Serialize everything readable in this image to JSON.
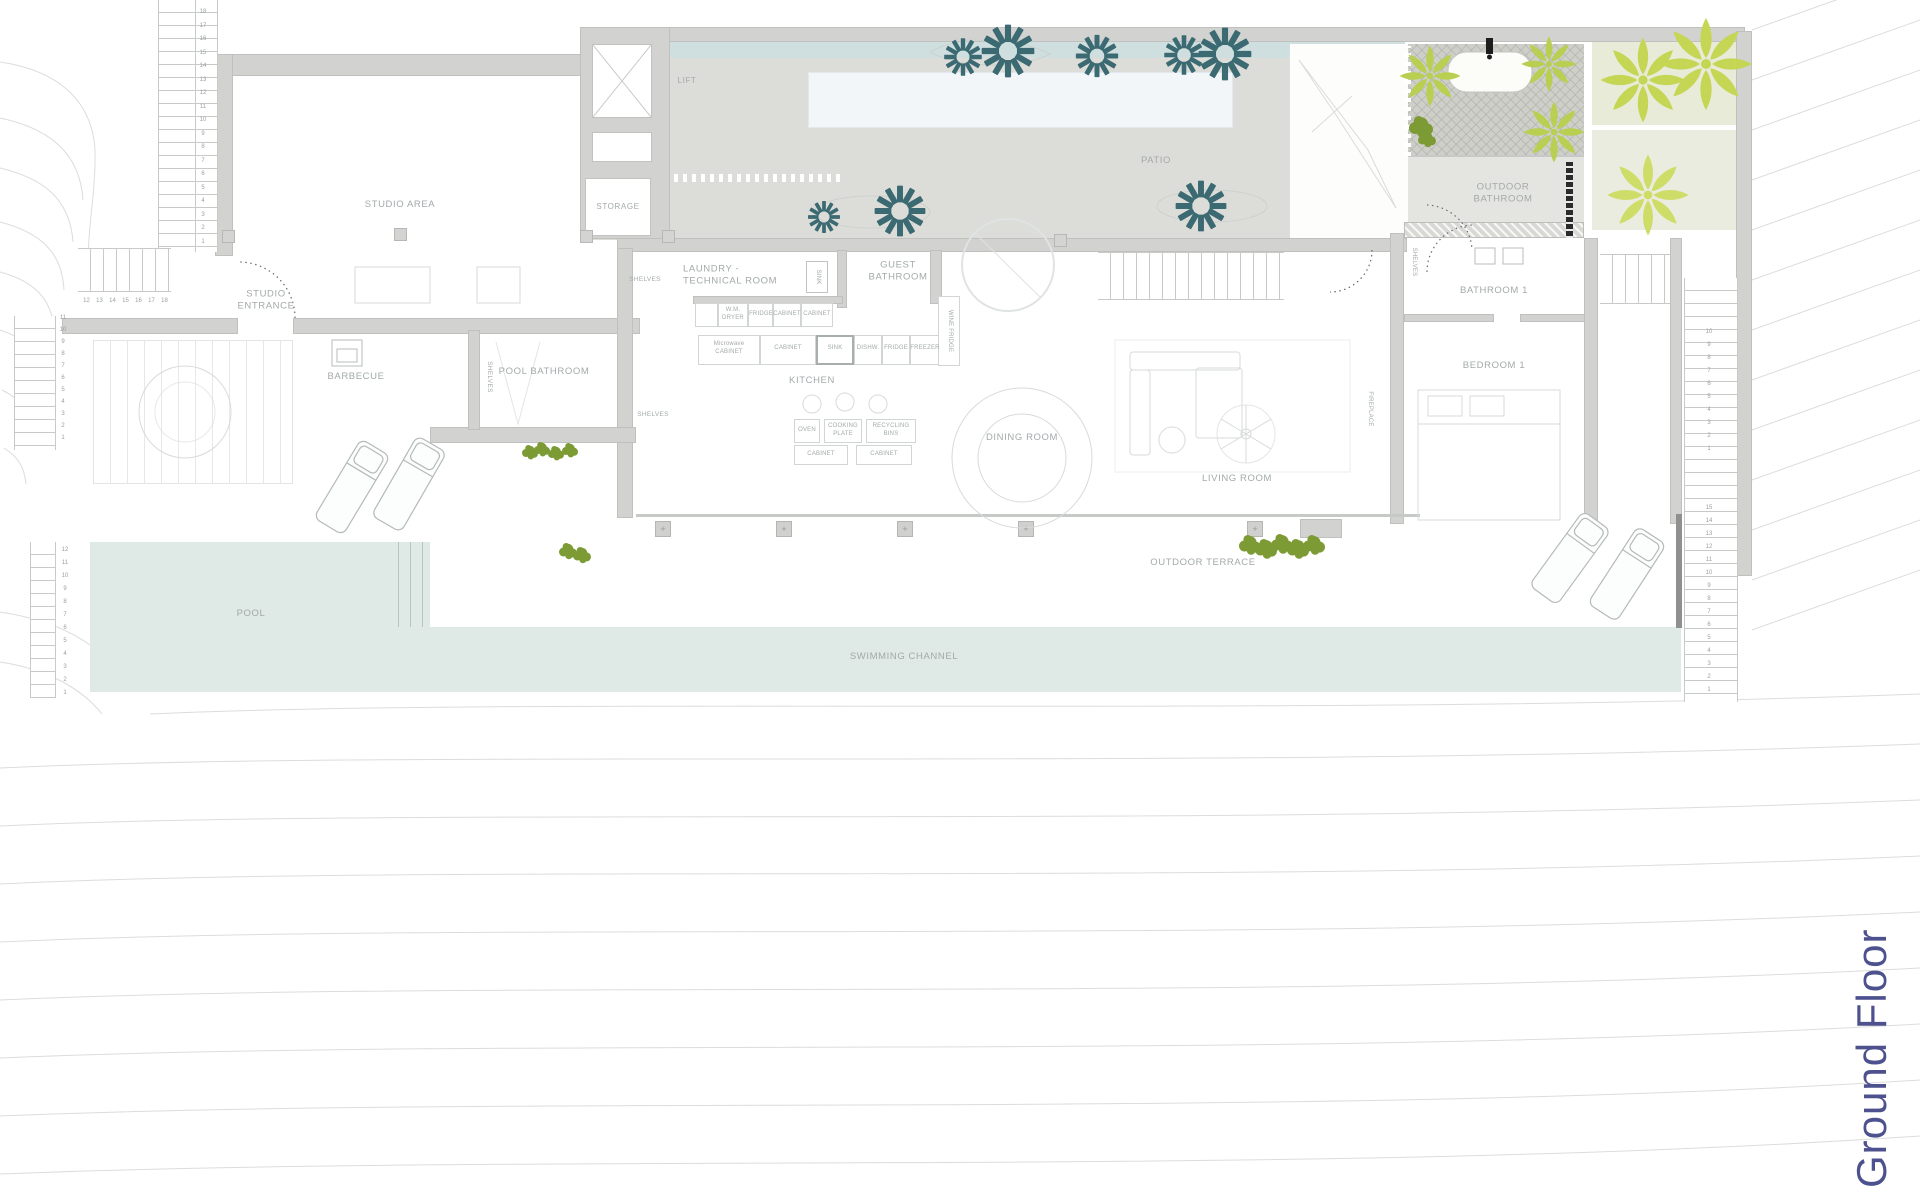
{
  "title": "Ground Floor",
  "rooms": {
    "lift": "LIFT",
    "storage": "STORAGE",
    "studio_area": "STUDIO AREA",
    "studio_entrance": "STUDIO\nENTRANCE",
    "barbecue": "BARBECUE",
    "pool_bathroom": "POOL BATHROOM",
    "laundry": "LAUNDRY -\nTECHNICAL ROOM",
    "guest_bathroom": "GUEST\nBATHROOM",
    "kitchen": "KITCHEN",
    "dining_room": "DINING ROOM",
    "living_room": "LIVING ROOM",
    "patio": "PATIO",
    "outdoor_bathroom": "OUTDOOR\nBATHROOM",
    "bathroom_1": "BATHROOM 1",
    "bedroom_1": "BEDROOM 1",
    "outdoor_terrace": "OUTDOOR TERRACE",
    "pool": "POOL",
    "swimming_channel": "SWIMMING CHANNEL"
  },
  "fixtures": {
    "shelves": "SHELVES",
    "wm_dryer": "W.M.\nDRYER",
    "fridge": "FRIDGE",
    "cabinet": "CABINET",
    "microwave_cabinet": "Microwave\nCABINET",
    "sink": "SINK",
    "dishwasher": "DISHW.",
    "freezer": "FREEZER",
    "wine_fridge": "WINE FRIDGE",
    "oven": "OVEN",
    "cooking_plate": "COOKING\nPLATE",
    "recycling_bins": "RECYCLING\nBINS",
    "fireplace": "FIREPLACE"
  },
  "stairs": {
    "northwest": [
      "18",
      "17",
      "16",
      "15",
      "14",
      "13",
      "12",
      "11",
      "10",
      "9",
      "8",
      "7",
      "6",
      "5",
      "4",
      "3",
      "2",
      "1"
    ],
    "west_upper": [
      "12",
      "13",
      "14",
      "15",
      "16",
      "17",
      "18"
    ],
    "west_lower": [
      "11",
      "10",
      "9",
      "8",
      "7",
      "6",
      "5",
      "4",
      "3",
      "2",
      "1"
    ],
    "pool_side": [
      "12",
      "11",
      "10",
      "9",
      "8",
      "7",
      "6",
      "5",
      "4",
      "3",
      "2",
      "1"
    ],
    "east_upper": [
      "10",
      "9",
      "8",
      "7",
      "6",
      "5",
      "4",
      "3",
      "2",
      "1"
    ],
    "east_lower": [
      "15",
      "14",
      "13",
      "12",
      "11",
      "10",
      "9",
      "8",
      "7",
      "6",
      "5",
      "4",
      "3",
      "2",
      "1"
    ]
  },
  "colors": {
    "title_accent": "#4d518e",
    "tree_teal": "#3c6a72",
    "palm_green": "#c4d654",
    "hedge_green": "#7d9b35",
    "pool_water": "#dfe9e5",
    "patio_gray": "#dcddd9"
  }
}
